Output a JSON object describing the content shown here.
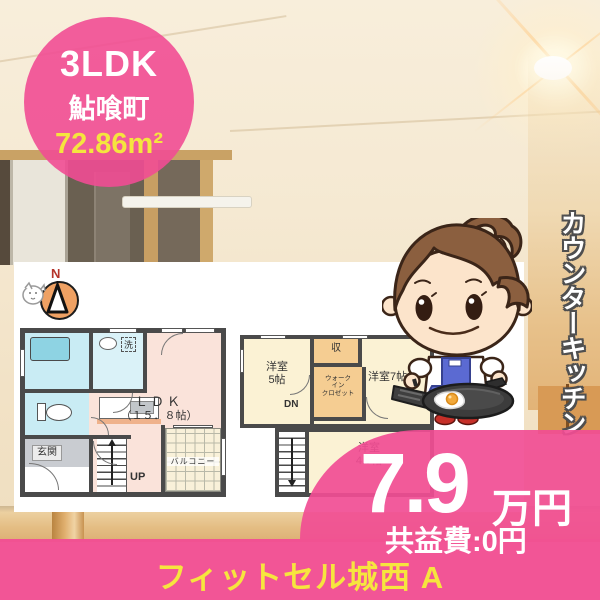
{
  "badge": {
    "layout_type": "3LDK",
    "area_name": "鮎喰町",
    "floor_area": "72.86m²"
  },
  "compass": {
    "north_label": "N"
  },
  "feature_ribbon": {
    "text": "カウンターキッチン"
  },
  "price": {
    "amount": "7.9",
    "unit": "万円",
    "common_fee": "共益費:0円"
  },
  "property": {
    "name": "フィットセル城西 A"
  },
  "floorplan_1f": {
    "ldk_label": "ＬＤＫ",
    "ldk_size": "（１５．８帖）",
    "entrance": "玄関",
    "laundry": "洗",
    "balcony": "バルコニー",
    "stairs_up": "UP"
  },
  "floorplan_2f": {
    "room5_name": "洋室",
    "room5_size": "5帖",
    "closet": "収",
    "wic_line1": "ウォーク",
    "wic_line2": "イン",
    "wic_line3": "クロゼット",
    "room7": "洋室7帖",
    "stairs_down": "DN",
    "room45_name": "洋室",
    "room45_size": "4.5帖"
  },
  "colors": {
    "accent_pink": "#f14d94",
    "accent_yellow": "#f5e53e",
    "wall_gray": "#4a4a4a",
    "wet_room_blue": "#c9ecf4",
    "room_cream": "#fbf2d4",
    "closet_orange": "#f5cd92",
    "ldk_pink": "#fae3da"
  }
}
